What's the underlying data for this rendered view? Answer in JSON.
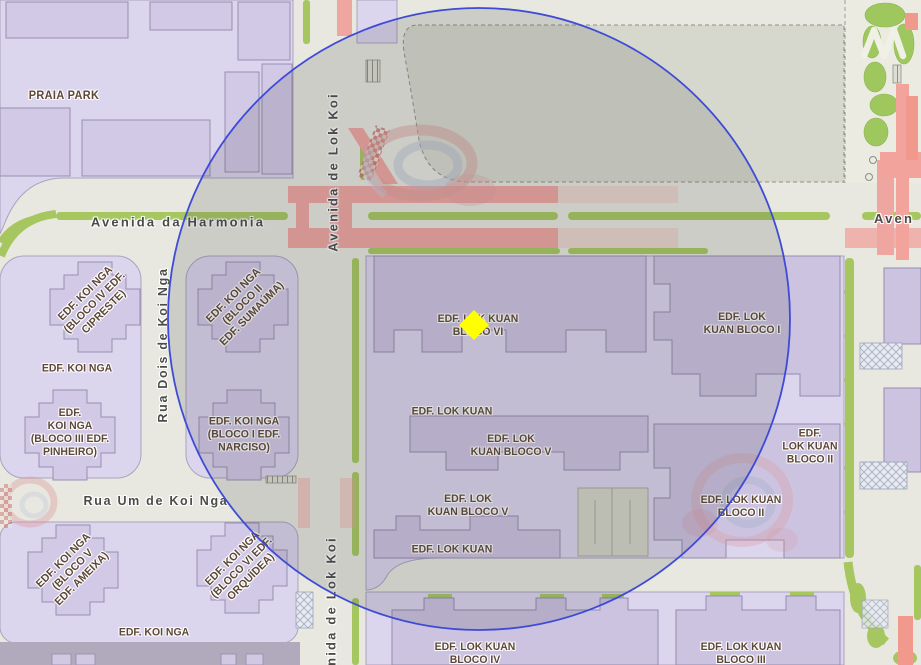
{
  "palette": {
    "road_background": "#E8E8E0",
    "block_fill": "#DCD5EE",
    "building_fill": "#D2C9E6",
    "building_outline": "#978FB0",
    "parcel_gray": "#D7D8CD",
    "green": "#A6C75F",
    "pink_road": "#EFA5A0",
    "street_label_color": "#4B4B48",
    "place_label_color": "#5D4737",
    "buffer_circle_stroke": "#3D4BD6",
    "marker_color": "#FFFF00"
  },
  "streets": [
    {
      "id": "avenida-da-harmonia",
      "text": "Avenida da Harmonia"
    },
    {
      "id": "avenida-de-lok-koi-north",
      "text": "Avenida de Lok Koi"
    },
    {
      "id": "rua-dois-de-koi-nga",
      "text": "Rua Dois de Koi Nga"
    },
    {
      "id": "rua-um-de-koi-nga",
      "text": "Rua Um de Koi Nga"
    },
    {
      "id": "avenida-de-lok-koi-south",
      "text": "Avenida de Lok Koi"
    },
    {
      "id": "avenida-partial-right-edge",
      "text": "Aven"
    }
  ],
  "places": [
    {
      "id": "praia-park",
      "text": "PRAIA PARK"
    },
    {
      "id": "edf-koi-nga-bloco-iv-cipreste",
      "text": "EDF. KOI NGA\n(BLOCO IV EDF.\nCIPRESTE)"
    },
    {
      "id": "edf-koi-nga",
      "text": "EDF. KOI NGA"
    },
    {
      "id": "edf-koi-nga-bloco-iii-pinheiro",
      "text": "EDF.\nKOI NGA\n(BLOCO III EDF.\nPINHEIRO)"
    },
    {
      "id": "edf-koi-nga-bloco-ii-sumauma",
      "text": "EDF. KOI NGA\n(BLOCO II\nEDF. SUMAÚMA)"
    },
    {
      "id": "edf-koi-nga-bloco-i-narciso",
      "text": "EDF. KOI NGA\n(BLOCO I EDF.\nNARCISO)"
    },
    {
      "id": "edf-lok-kuan-bloco-vi",
      "text": "EDF. LOK KUAN\nBLOCO VI"
    },
    {
      "id": "edf-lok-kuan-bloco-i",
      "text": "EDF. LOK\nKUAN BLOCO I"
    },
    {
      "id": "edf-lok-kuan-mid",
      "text": "EDF. LOK KUAN"
    },
    {
      "id": "edf-lok-kuan-bloco-v-upper",
      "text": "EDF. LOK\nKUAN BLOCO V"
    },
    {
      "id": "edf-lok-kuan-bloco-ii-east",
      "text": "EDF.\nLOK KUAN\nBLOCO II"
    },
    {
      "id": "edf-lok-kuan-bloco-v-lower",
      "text": "EDF. LOK\nKUAN BLOCO V"
    },
    {
      "id": "edf-lok-kuan-bloco-ii-south",
      "text": "EDF. LOK KUAN\nBLOCO II"
    },
    {
      "id": "edf-lok-kuan-lower",
      "text": "EDF. LOK KUAN"
    },
    {
      "id": "edf-koi-nga-bloco-v-ameixa",
      "text": "EDF. KOI NGA\n(BLOCO V\nEDF. AMEIXA)"
    },
    {
      "id": "edf-koi-nga-bloco-vi-orquidea",
      "text": "EDF. KOI NGA\n(BLOCO VI EDF.\nORQUÍDEA)"
    },
    {
      "id": "edf-koi-nga-south",
      "text": "EDF. KOI NGA"
    },
    {
      "id": "edf-lok-kuan-bloco-iv",
      "text": "EDF. LOK KUAN\nBLOCO IV"
    },
    {
      "id": "edf-lok-kuan-bloco-iii",
      "text": "EDF. LOK KUAN\nBLOCO III"
    }
  ],
  "marker": {
    "shape": "diamond",
    "color": "#FFFF00"
  },
  "buffer_circle": {
    "stroke_color": "#3D4BD6",
    "fill_color": "rgba(70,70,75,0.16)"
  }
}
